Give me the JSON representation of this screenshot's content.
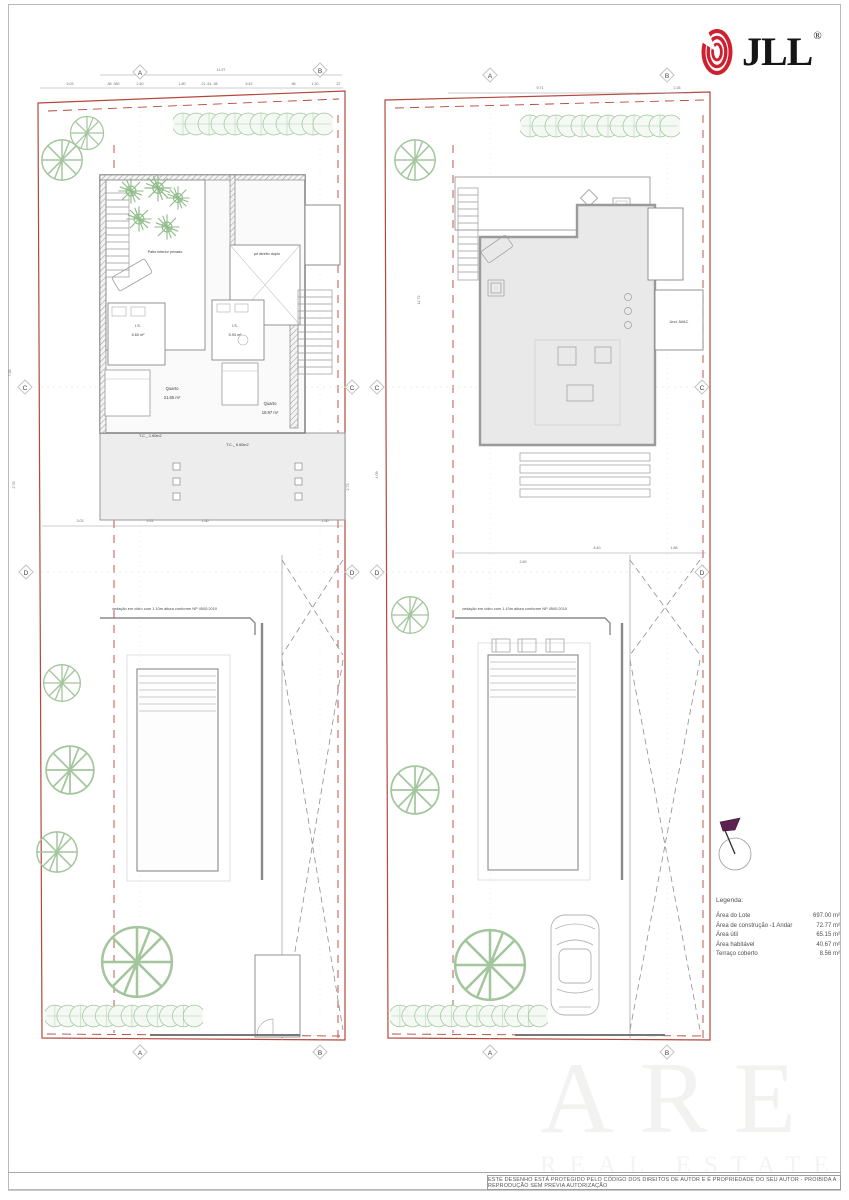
{
  "header": {
    "brand": "JLL",
    "registered": "®"
  },
  "grid": {
    "a": "A",
    "b": "B",
    "c": "C",
    "d": "D"
  },
  "left_plan": {
    "dim_total": "11.97",
    "dims_top": [
      "3.03",
      ".38 .380",
      "2.40",
      "1.80",
      ".21 .61 .38",
      "5.42",
      ".98",
      "1.30",
      ".37"
    ],
    "dims_mid": [
      "3.03",
      "5.31",
      "1.50",
      "1.50"
    ],
    "dims_left": [
      "7.38",
      "2.78"
    ],
    "dims_right": [
      "2.73"
    ],
    "labels": {
      "patio": "Patio interior privado",
      "double_height": "pé direito duplo",
      "is1": "I.S.",
      "is1_area": "6.60 m²",
      "is2": "I.S.",
      "is2_area": "5.93 m²",
      "bedroom1": "Quarto",
      "bedroom1_area": "21.65 m²",
      "bedroom2": "Quarto",
      "bedroom2_area": "18.97 m²",
      "tc1": "T.C._ 1.60m2",
      "tc2": "T.C._ 6.60m2"
    },
    "fence_note": "vedação em vidro com 1.10m altura conforme NP 4500:2010"
  },
  "right_plan": {
    "dim_total": "9.71",
    "dim_right": "2.26",
    "dims_left": [
      "12.72",
      "4.09"
    ],
    "dims_mid": [
      "2.69",
      "8.40",
      "1.88"
    ],
    "labels": {
      "avac": "Und. AVAC"
    },
    "fence_note": "vedação em vidro com 1.10m altura conforme NP 4500:2010"
  },
  "legend": {
    "title": "Legenda:",
    "items": [
      {
        "label": "Área do Lote",
        "value": "697.00 m²"
      },
      {
        "label": "Área de construção -1 Andar",
        "value": "72.77 m²"
      },
      {
        "label": "Área útil",
        "value": "65.15 m²"
      },
      {
        "label": "Área habitável",
        "value": "40.67 m²"
      },
      {
        "label": "Terraço coberto",
        "value": "8.56 m²"
      }
    ]
  },
  "watermark": {
    "line1": "ARE",
    "line2": "REAL ESTATE"
  },
  "footer": {
    "copyright": "ESTE DESENHO ESTÁ PROTEGIDO PELO CÓDIGO DOS DIREITOS DE AUTOR E É PROPRIEDADE DO SEU AUTOR - PROIBIDA A REPRODUÇÃO SEM PRÉVIA AUTORIZAÇÃO"
  },
  "colors": {
    "boundary_red": "#b5473c",
    "brand_red": "#cf2030",
    "plant_green": "#a3c69d",
    "wall_gray": "#8a8a8a",
    "fill_gray": "#e9e9e9"
  }
}
